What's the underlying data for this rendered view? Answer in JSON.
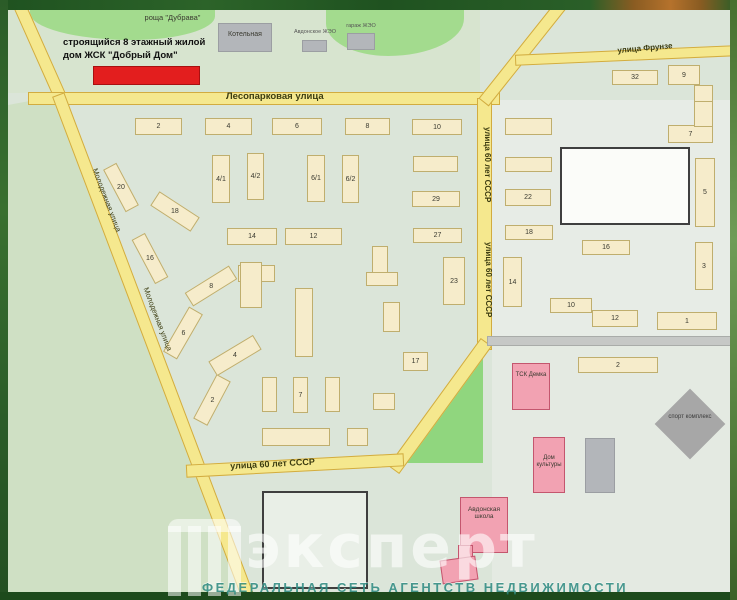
{
  "legend": {
    "line1": "строящийся 8 этажный жилой",
    "line2": "дом ЖСК \"Добрый Дом\""
  },
  "streets": {
    "lesoparkovaya": "Лесопарковая улица",
    "frunze": "улица Фрунзе",
    "sssr60": "улица 60 лет СССР",
    "molodezhnaya": "Молодежная улица"
  },
  "areas": {
    "grove": "роща \"Дубрава\""
  },
  "landmarks": {
    "kotelnaya": "Котельная",
    "avdon_zheo": "Авдонское ЖЭО",
    "garazh_zheo": "гараж ЖЭО",
    "tsk": "ТСК Демка",
    "dom_kultury": "Дом культуры",
    "school": "Авдонская школа",
    "sport": "спорт комплекс"
  },
  "watermark": {
    "brand": "эксперт",
    "tagline": "ФЕДЕРАЛЬНАЯ СЕТЬ АГЕНТСТВ НЕДВИЖИМОСТИ"
  },
  "colors": {
    "map_base": "#dbe5d9",
    "road_fill": "#f5e88e",
    "road_border": "#d2ac40",
    "house_fill": "#f6eccb",
    "house_border": "#bfae6e",
    "pink_fill": "#f2a2b2",
    "red_fill": "#e31e1e",
    "gray_fill": "#b3b6ba",
    "grove_fill": "#a3db8e",
    "border_green": "#24581f"
  },
  "buildings": [
    {
      "kind": "house",
      "label": "2",
      "x": 135,
      "y": 118,
      "w": 47,
      "h": 17,
      "r": 0
    },
    {
      "kind": "house",
      "label": "4",
      "x": 205,
      "y": 118,
      "w": 47,
      "h": 17,
      "r": 0
    },
    {
      "kind": "house",
      "label": "6",
      "x": 272,
      "y": 118,
      "w": 50,
      "h": 17,
      "r": 0
    },
    {
      "kind": "house",
      "label": "8",
      "x": 345,
      "y": 118,
      "w": 45,
      "h": 17,
      "r": 0
    },
    {
      "kind": "house",
      "label": "10",
      "x": 412,
      "y": 119,
      "w": 50,
      "h": 16,
      "r": 0
    },
    {
      "kind": "house",
      "label": "4/1",
      "x": 212,
      "y": 155,
      "w": 18,
      "h": 48,
      "r": 0
    },
    {
      "kind": "house",
      "label": "4/2",
      "x": 247,
      "y": 153,
      "w": 17,
      "h": 47,
      "r": 0
    },
    {
      "kind": "house",
      "label": "6/1",
      "x": 307,
      "y": 155,
      "w": 18,
      "h": 47,
      "r": 0
    },
    {
      "kind": "house",
      "label": "6/2",
      "x": 342,
      "y": 155,
      "w": 17,
      "h": 48,
      "r": 0
    },
    {
      "kind": "house",
      "label": "",
      "x": 413,
      "y": 156,
      "w": 45,
      "h": 16,
      "r": 0
    },
    {
      "kind": "house",
      "label": "29",
      "x": 412,
      "y": 191,
      "w": 48,
      "h": 16,
      "r": 0
    },
    {
      "kind": "house",
      "label": "27",
      "x": 413,
      "y": 228,
      "w": 49,
      "h": 15,
      "r": 0
    },
    {
      "kind": "house",
      "label": "23",
      "x": 443,
      "y": 257,
      "w": 22,
      "h": 48,
      "r": 0
    },
    {
      "kind": "house",
      "label": "",
      "x": 505,
      "y": 118,
      "w": 47,
      "h": 17,
      "r": 0
    },
    {
      "kind": "house",
      "label": "",
      "x": 505,
      "y": 157,
      "w": 47,
      "h": 15,
      "r": 0
    },
    {
      "kind": "house",
      "label": "22",
      "x": 505,
      "y": 189,
      "w": 46,
      "h": 17,
      "r": 0
    },
    {
      "kind": "house",
      "label": "18",
      "x": 505,
      "y": 225,
      "w": 48,
      "h": 15,
      "r": 0
    },
    {
      "kind": "house",
      "label": "14",
      "x": 503,
      "y": 257,
      "w": 19,
      "h": 50,
      "r": 0
    },
    {
      "kind": "house",
      "label": "16",
      "x": 582,
      "y": 240,
      "w": 48,
      "h": 15,
      "r": 0
    },
    {
      "kind": "house",
      "label": "10",
      "x": 550,
      "y": 298,
      "w": 42,
      "h": 15,
      "r": 0
    },
    {
      "kind": "house",
      "label": "12",
      "x": 592,
      "y": 310,
      "w": 46,
      "h": 17,
      "r": 0
    },
    {
      "kind": "house",
      "label": "1",
      "x": 657,
      "y": 312,
      "w": 60,
      "h": 18,
      "r": 0
    },
    {
      "kind": "house",
      "label": "3",
      "x": 695,
      "y": 242,
      "w": 18,
      "h": 48,
      "r": 0
    },
    {
      "kind": "house",
      "label": "5",
      "x": 695,
      "y": 158,
      "w": 20,
      "h": 69,
      "r": 0
    },
    {
      "kind": "house",
      "label": "7",
      "x": 668,
      "y": 125,
      "w": 45,
      "h": 18,
      "r": 0
    },
    {
      "kind": "house",
      "label": "",
      "x": 694,
      "y": 100,
      "w": 19,
      "h": 27,
      "r": 0
    },
    {
      "kind": "house",
      "label": "9",
      "x": 668,
      "y": 65,
      "w": 32,
      "h": 20,
      "r": 0
    },
    {
      "kind": "house",
      "label": "",
      "x": 694,
      "y": 85,
      "w": 19,
      "h": 17,
      "r": 0
    },
    {
      "kind": "house",
      "label": "32",
      "x": 612,
      "y": 70,
      "w": 46,
      "h": 15,
      "r": 0
    },
    {
      "kind": "house",
      "label": "14",
      "x": 227,
      "y": 228,
      "w": 50,
      "h": 17,
      "r": 0
    },
    {
      "kind": "house",
      "label": "12",
      "x": 285,
      "y": 228,
      "w": 57,
      "h": 17,
      "r": 0
    },
    {
      "kind": "house",
      "label": "20",
      "x": 97,
      "y": 180,
      "w": 48,
      "h": 15,
      "r": 62
    },
    {
      "kind": "house",
      "label": "18",
      "x": 151,
      "y": 203,
      "w": 48,
      "h": 17,
      "r": 33
    },
    {
      "kind": "house",
      "label": "16",
      "x": 125,
      "y": 251,
      "w": 50,
      "h": 15,
      "r": 62
    },
    {
      "kind": "house",
      "label": "8",
      "x": 185,
      "y": 278,
      "w": 52,
      "h": 16,
      "r": -32
    },
    {
      "kind": "house",
      "label": "10",
      "x": 238,
      "y": 265,
      "w": 37,
      "h": 17,
      "r": 0
    },
    {
      "kind": "house",
      "label": "6",
      "x": 157,
      "y": 325,
      "w": 52,
      "h": 16,
      "r": -60
    },
    {
      "kind": "house",
      "label": "4",
      "x": 209,
      "y": 347,
      "w": 52,
      "h": 17,
      "r": -31
    },
    {
      "kind": "house",
      "label": "2",
      "x": 187,
      "y": 392,
      "w": 50,
      "h": 16,
      "r": -62
    },
    {
      "kind": "house",
      "label": "",
      "x": 240,
      "y": 262,
      "w": 22,
      "h": 46,
      "r": 0
    },
    {
      "kind": "house",
      "label": "",
      "x": 295,
      "y": 288,
      "w": 18,
      "h": 69,
      "r": 0
    },
    {
      "kind": "house",
      "label": "",
      "x": 372,
      "y": 246,
      "w": 16,
      "h": 28,
      "r": 0
    },
    {
      "kind": "house",
      "label": "",
      "x": 366,
      "y": 272,
      "w": 32,
      "h": 14,
      "r": 0
    },
    {
      "kind": "house",
      "label": "",
      "x": 383,
      "y": 302,
      "w": 17,
      "h": 30,
      "r": 0
    },
    {
      "kind": "house",
      "label": "",
      "x": 262,
      "y": 377,
      "w": 15,
      "h": 35,
      "r": 0
    },
    {
      "kind": "house",
      "label": "7",
      "x": 293,
      "y": 377,
      "w": 15,
      "h": 36,
      "r": 0
    },
    {
      "kind": "house",
      "label": "",
      "x": 325,
      "y": 377,
      "w": 15,
      "h": 35,
      "r": 0
    },
    {
      "kind": "house",
      "label": "",
      "x": 373,
      "y": 393,
      "w": 22,
      "h": 17,
      "r": 0
    },
    {
      "kind": "house",
      "label": "17",
      "x": 403,
      "y": 352,
      "w": 25,
      "h": 19,
      "r": 0
    },
    {
      "kind": "house",
      "label": "",
      "x": 262,
      "y": 428,
      "w": 68,
      "h": 18,
      "r": 0
    },
    {
      "kind": "house",
      "label": "",
      "x": 347,
      "y": 428,
      "w": 21,
      "h": 18,
      "r": 0
    },
    {
      "kind": "house",
      "label": "2",
      "x": 578,
      "y": 357,
      "w": 80,
      "h": 16,
      "r": 0
    },
    {
      "kind": "gray",
      "label": "",
      "x": 218,
      "y": 23,
      "w": 54,
      "h": 29,
      "r": 0
    },
    {
      "kind": "gray",
      "label": "",
      "x": 302,
      "y": 40,
      "w": 25,
      "h": 12,
      "r": 0
    },
    {
      "kind": "gray",
      "label": "",
      "x": 347,
      "y": 33,
      "w": 28,
      "h": 17,
      "r": 0
    },
    {
      "kind": "gray",
      "label": "",
      "x": 585,
      "y": 438,
      "w": 30,
      "h": 55,
      "r": 0
    },
    {
      "kind": "diamond",
      "label": "",
      "x": 665,
      "y": 399,
      "w": 50,
      "h": 50,
      "r": 45
    },
    {
      "kind": "pink",
      "label": "",
      "x": 512,
      "y": 363,
      "w": 38,
      "h": 47,
      "r": 0
    },
    {
      "kind": "pink",
      "label": "",
      "x": 533,
      "y": 437,
      "w": 32,
      "h": 56,
      "r": 0
    },
    {
      "kind": "pink",
      "label": "",
      "x": 460,
      "y": 497,
      "w": 48,
      "h": 56,
      "r": 0
    },
    {
      "kind": "pink",
      "label": "",
      "x": 458,
      "y": 545,
      "w": 15,
      "h": 17,
      "r": 0
    },
    {
      "kind": "pink",
      "label": "",
      "x": 441,
      "y": 558,
      "w": 36,
      "h": 24,
      "r": -8
    },
    {
      "kind": "red",
      "label": "",
      "x": 93,
      "y": 66,
      "w": 107,
      "h": 19,
      "r": 0
    },
    {
      "kind": "lot",
      "label": "",
      "x": 560,
      "y": 147,
      "w": 130,
      "h": 78,
      "r": 0
    },
    {
      "kind": "lot2",
      "label": "",
      "x": 262,
      "y": 491,
      "w": 106,
      "h": 98,
      "r": 0
    }
  ]
}
